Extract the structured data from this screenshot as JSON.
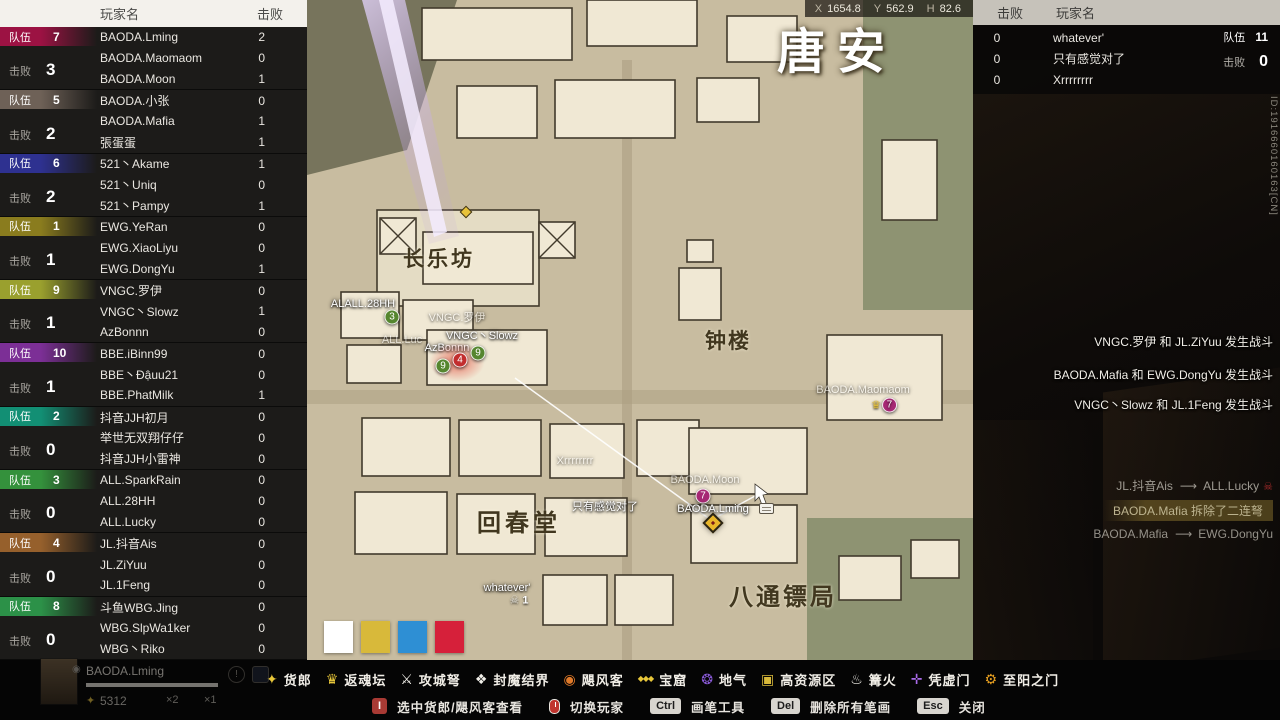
{
  "left_panel": {
    "header": {
      "name_col": "玩家名",
      "kills_col": "击败"
    },
    "team_label": "队伍",
    "kills_label": "击败",
    "teams": [
      {
        "id": 7,
        "color": "#9c1243",
        "kills": 3,
        "players": [
          {
            "name": "BAODA.Lming",
            "kills": 2
          },
          {
            "name": "BAODA.Maomaom",
            "kills": 0
          },
          {
            "name": "BAODA.Moon",
            "kills": 1
          }
        ]
      },
      {
        "id": 5,
        "color": "#6e6157",
        "kills": 2,
        "players": [
          {
            "name": "BAODA.小张",
            "kills": 0
          },
          {
            "name": "BAODA.Mafia",
            "kills": 1
          },
          {
            "name": "張蛋蛋",
            "kills": 1
          }
        ]
      },
      {
        "id": 6,
        "color": "#2e3190",
        "kills": 2,
        "players": [
          {
            "name": "521丶Akame",
            "kills": 1
          },
          {
            "name": "521丶Uniq",
            "kills": 0
          },
          {
            "name": "521丶Pampy",
            "kills": 1
          }
        ]
      },
      {
        "id": 1,
        "color": "#8a7c1e",
        "kills": 1,
        "players": [
          {
            "name": "EWG.YeRan",
            "kills": 0
          },
          {
            "name": "EWG.XiaoLiyu",
            "kills": 0
          },
          {
            "name": "EWG.DongYu",
            "kills": 1
          }
        ]
      },
      {
        "id": 9,
        "color": "#9aa02e",
        "kills": 1,
        "players": [
          {
            "name": "VNGC.罗伊",
            "kills": 0
          },
          {
            "name": "VNGC丶Slowz",
            "kills": 1
          },
          {
            "name": "AzBonnn",
            "kills": 0
          }
        ]
      },
      {
        "id": 10,
        "color": "#7c2f96",
        "kills": 1,
        "players": [
          {
            "name": "BBE.iBinn99",
            "kills": 0
          },
          {
            "name": "BBE丶Đậuu21",
            "kills": 0
          },
          {
            "name": "BBE.PhatMilk",
            "kills": 1
          }
        ]
      },
      {
        "id": 2,
        "color": "#128f74",
        "kills": 0,
        "players": [
          {
            "name": "抖音JJH初月",
            "kills": 0
          },
          {
            "name": "举世无双翔仔仔",
            "kills": 0
          },
          {
            "name": "抖音JJH小雷神",
            "kills": 0
          }
        ]
      },
      {
        "id": 3,
        "color": "#34913c",
        "kills": 0,
        "players": [
          {
            "name": "ALL.SparkRain",
            "kills": 0
          },
          {
            "name": "ALL.28HH",
            "kills": 0
          },
          {
            "name": "ALL.Lucky",
            "kills": 0
          }
        ]
      },
      {
        "id": 4,
        "color": "#96602c",
        "kills": 0,
        "players": [
          {
            "name": "JL.抖音Ais",
            "kills": 0
          },
          {
            "name": "JL.ZiYuu",
            "kills": 0
          },
          {
            "name": "JL.1Feng",
            "kills": 0
          }
        ]
      },
      {
        "id": 8,
        "color": "#2c9148",
        "kills": 0,
        "players": [
          {
            "name": "斗鱼WBG.Jing",
            "kills": 0
          },
          {
            "name": "WBG.SlpWa1ker",
            "kills": 0
          },
          {
            "name": "WBG丶Riko",
            "kills": 0
          }
        ]
      }
    ]
  },
  "right_panel": {
    "header": {
      "kills_col": "击败",
      "name_col": "玩家名"
    },
    "team_label": "队伍",
    "team_id": "11",
    "kills_label": "击败",
    "team_kills": "0",
    "players": [
      {
        "kills": "0",
        "name": "whatever'"
      },
      {
        "kills": "0",
        "name": "只有感觉对了"
      },
      {
        "kills": "0",
        "name": "Xrrrrrrrr"
      }
    ],
    "vertical_id": "ID:1916660160163[CN]",
    "battle_messages": [
      "VNGC.罗伊 和 JL.ZiYuu 发生战斗",
      "BAODA.Mafia 和 EWG.DongYu 发生战斗",
      "VNGC丶Slowz 和 JL.1Feng 发生战斗"
    ],
    "kill_feed": [
      {
        "type": "arrow",
        "left": "JL.抖音Ais",
        "right": "ALL.Lucky",
        "skull": true
      },
      {
        "type": "highlight",
        "text": "BAODA.Mafia 拆除了二连弩"
      },
      {
        "type": "arrow",
        "left": "BAODA.Mafia",
        "right": "EWG.DongYu",
        "skull": false
      }
    ]
  },
  "map": {
    "coords": {
      "x_label": "X",
      "x": "1654.8",
      "y_label": "Y",
      "y": "562.9",
      "h_label": "H",
      "h": "82.6"
    },
    "title": "唐安",
    "locations": [
      "长乐坊",
      "钟楼",
      "回春堂",
      "八通镖局"
    ],
    "markers": [
      {
        "type": "diamond-small",
        "x": 159,
        "y": 212
      },
      {
        "type": "label",
        "text": "ALALL.28HH",
        "x": 56,
        "y": 304
      },
      {
        "type": "circle",
        "text": "3",
        "color": "green",
        "x": 85,
        "y": 317
      },
      {
        "type": "label",
        "text": "VNGC.罗伊",
        "x": 150,
        "y": 317,
        "dim": true
      },
      {
        "type": "label",
        "text": "VNGC丶Slowz",
        "x": 175,
        "y": 335
      },
      {
        "type": "label",
        "text": "AzBonnn",
        "x": 140,
        "y": 348
      },
      {
        "type": "label",
        "text": "ALL.Luc",
        "x": 95,
        "y": 340,
        "dim": true
      },
      {
        "type": "glow",
        "x": 150,
        "y": 362,
        "w": 56,
        "h": 40
      },
      {
        "type": "circle",
        "text": "9",
        "color": "green",
        "x": 136,
        "y": 366
      },
      {
        "type": "circle",
        "text": "4",
        "color": "red",
        "x": 153,
        "y": 360
      },
      {
        "type": "circle",
        "text": "9",
        "color": "green",
        "x": 171,
        "y": 353
      },
      {
        "type": "label",
        "text": "BAODA.Maomaom",
        "x": 556,
        "y": 390,
        "dim": true
      },
      {
        "type": "crown-circle",
        "text": "7",
        "x": 577,
        "y": 405
      },
      {
        "type": "label",
        "text": "Xrrrrrrrr",
        "x": 268,
        "y": 461,
        "dim": true
      },
      {
        "type": "label",
        "text": "BAODA.Moon",
        "x": 398,
        "y": 480,
        "dim": true
      },
      {
        "type": "circle",
        "text": "7",
        "color": "magenta",
        "x": 396,
        "y": 496
      },
      {
        "type": "label",
        "text": "BAODA.Lming",
        "x": 406,
        "y": 509
      },
      {
        "type": "diamond-player",
        "x": 406,
        "y": 523
      },
      {
        "type": "label",
        "text": "只有感觉对了",
        "x": 298,
        "y": 506
      },
      {
        "type": "label",
        "text": "whatever'",
        "x": 200,
        "y": 588
      },
      {
        "type": "skull",
        "text": "1",
        "x": 212,
        "y": 600
      }
    ],
    "palette_colors": [
      "#ffffff",
      "#d8b93a",
      "#2e8fd4",
      "#d6203a"
    ]
  },
  "bottom_bar": {
    "legend": [
      {
        "icon": "peddler-icon",
        "glyph": "✦",
        "color": "#e8c73a",
        "label": "货郎"
      },
      {
        "icon": "soul-altar-icon",
        "glyph": "♛",
        "color": "#e8c73a",
        "label": "返魂坛"
      },
      {
        "icon": "siege-crossbow-icon",
        "glyph": "⚔",
        "color": "#f2f0ea",
        "label": "攻城弩"
      },
      {
        "icon": "sealing-barrier-icon",
        "glyph": "❖",
        "color": "#f2f0ea",
        "label": "封魔结界"
      },
      {
        "icon": "hurricane-courier-icon",
        "glyph": "◉",
        "color": "#e07a2a",
        "label": "飓风客"
      },
      {
        "icon": "treasure-cave-icon",
        "glyph": "◆◆◆",
        "color": "#e8c73a",
        "small": true,
        "label": "宝窟"
      },
      {
        "icon": "earth-qi-icon",
        "glyph": "❂",
        "color": "#8a5ad8",
        "label": "地气"
      },
      {
        "icon": "high-resource-icon",
        "glyph": "▣",
        "color": "#d8b93a",
        "label": "高资源区"
      },
      {
        "icon": "campfire-icon",
        "glyph": "♨",
        "color": "#f2f0ea",
        "label": "篝火"
      },
      {
        "icon": "void-gate-icon",
        "glyph": "✛",
        "color": "#a86ae8",
        "label": "凭虚门"
      },
      {
        "icon": "sun-gate-icon",
        "glyph": "⚙",
        "color": "#e8a020",
        "label": "至阳之门"
      }
    ],
    "hints": [
      {
        "key": "I",
        "red": true,
        "label": "选中货郎/飓风客查看"
      },
      {
        "mouse": true,
        "label": "切换玩家"
      },
      {
        "key": "Ctrl",
        "label": "画笔工具"
      },
      {
        "key": "Del",
        "label": "删除所有笔画"
      },
      {
        "key": "Esc",
        "label": "关闭"
      }
    ]
  },
  "player_card": {
    "name": "BAODA.Lming",
    "currency": "5312",
    "mult1": "×2",
    "mult2": "×1"
  }
}
